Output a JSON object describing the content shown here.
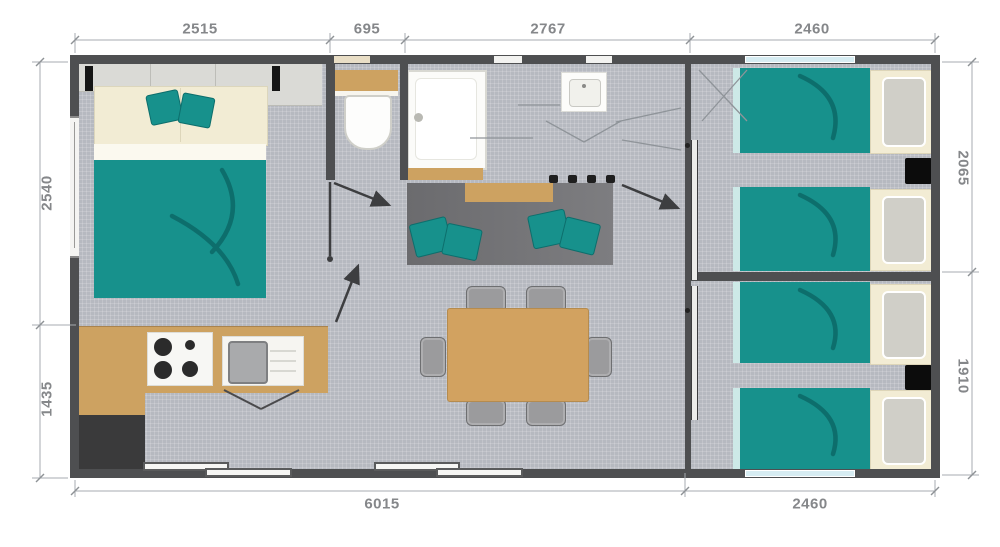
{
  "dimensions": {
    "top": [
      {
        "label": "2515"
      },
      {
        "label": "695"
      },
      {
        "label": "2767"
      },
      {
        "label": "2460"
      }
    ],
    "bottom": [
      {
        "label": "6015"
      },
      {
        "label": "2460"
      }
    ],
    "left": [
      {
        "label": "2540"
      },
      {
        "label": "1435"
      }
    ],
    "right": [
      {
        "label": "2065"
      },
      {
        "label": "1910"
      }
    ]
  },
  "colors": {
    "wall": "#4e4f51",
    "floor": "#b6b9c0",
    "teal": "#17918c",
    "teal-dark": "#0d6e6c",
    "teal-light": "#cde9e7",
    "wood": "#cda261",
    "cream": "#f2ecd4",
    "sofa": "#727275",
    "charcoal": "#3a3a3b",
    "chair": "#9b9b9d",
    "dim-line": "#a7abb0",
    "dim-text": "#85878a",
    "window-glass": "#d6ecf2",
    "appliance-white": "#f7f7f4",
    "wardrobe": "#dadad6"
  }
}
